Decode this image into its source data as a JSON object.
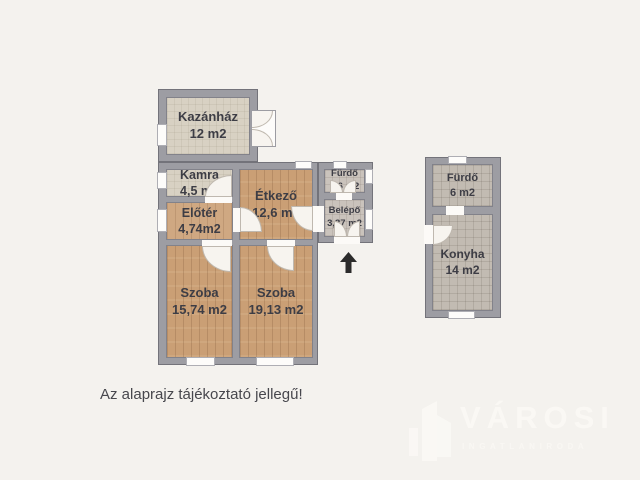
{
  "plan": {
    "note": "Az alaprajz tájékoztató jellegű!",
    "rooms": {
      "kazanhaz": {
        "name": "Kazánház",
        "area": "12 m2"
      },
      "kamra": {
        "name": "Kamra",
        "area": "4,5 m2"
      },
      "eloter": {
        "name": "Előtér",
        "area": "4,74m2"
      },
      "etkezo": {
        "name": "Étkező",
        "area": "12,6 m2"
      },
      "furdo_kis": {
        "name": "Fürdő",
        "area": "3,6 m2"
      },
      "belepo": {
        "name": "Belépő",
        "area": "3,37 m2"
      },
      "szoba_1": {
        "name": "Szoba",
        "area": "15,74 m2"
      },
      "szoba_2": {
        "name": "Szoba",
        "area": "19,13 m2"
      },
      "furdo_mellek": {
        "name": "Fürdő",
        "area": "6 m2"
      },
      "konyha": {
        "name": "Konyha",
        "area": "14 m2"
      }
    }
  },
  "branding": {
    "brand": "VÁROSI",
    "subtitle": "INGATLANIRODA"
  },
  "icons": {
    "entry_arrow": "arrow-up-icon",
    "logo_mark": "buildings-icon"
  },
  "colors": {
    "background": "#f4f2ee",
    "wall": "#9d9da3",
    "wood_floor": "#ca9f75",
    "screed_floor": "#d8d1c3",
    "tile_floor": "#cac3bc",
    "annex_tile_floor": "#c2bbb2",
    "label_text": "#3d3d45",
    "entry_arrow": "#2b2b2b",
    "logo": "#faf8f4"
  }
}
